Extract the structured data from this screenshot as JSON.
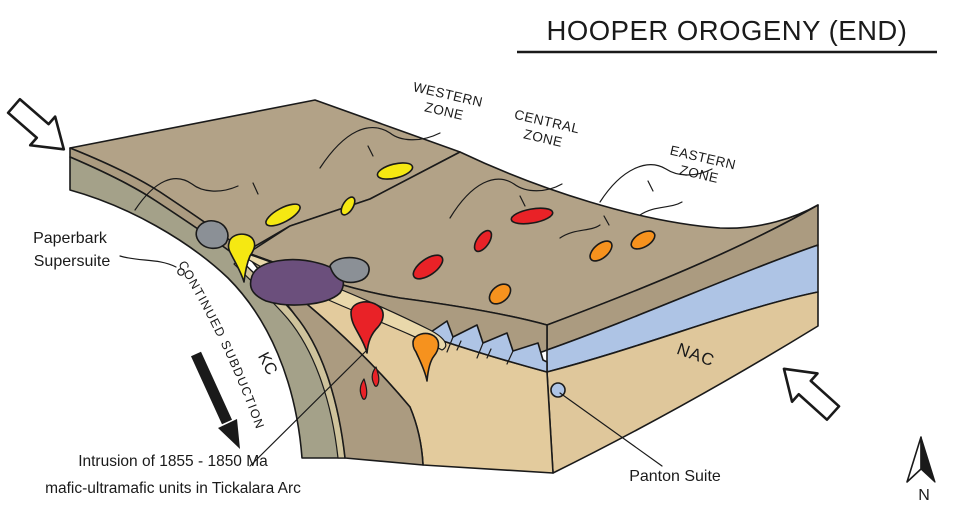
{
  "title": "HOOPER OROGENY (END)",
  "zones": [
    {
      "line1": "WESTERN",
      "line2": "ZONE"
    },
    {
      "line1": "CENTRAL",
      "line2": "ZONE"
    },
    {
      "line1": "EASTERN",
      "line2": "ZONE"
    }
  ],
  "labels": {
    "paperbark_line1": "Paperbark",
    "paperbark_line2": "Supersuite",
    "subduction": "CONTINUED SUBDUCTION",
    "kc": "KC",
    "nac": "NAC",
    "panton": "Panton Suite",
    "intrusion_line1": "Intrusion of 1855 - 1850 Ma",
    "intrusion_line2": "mafic-ultramafic units in Tickalara Arc",
    "north": "N"
  },
  "colors": {
    "surface_brown": "#b2a287",
    "face_brown": "#ab9b80",
    "kc_green": "#a4a189",
    "stripe_tan": "#cfc39c",
    "wedge_tan": "#e3cb9d",
    "nac_tan": "#dfc79b",
    "cream": "#e9d8ab",
    "blue": "#aec4e5",
    "purple": "#6b4f7c",
    "gray": "#8b9096",
    "yellow": "#f5e812",
    "red": "#e92227",
    "orange": "#f6921e"
  }
}
